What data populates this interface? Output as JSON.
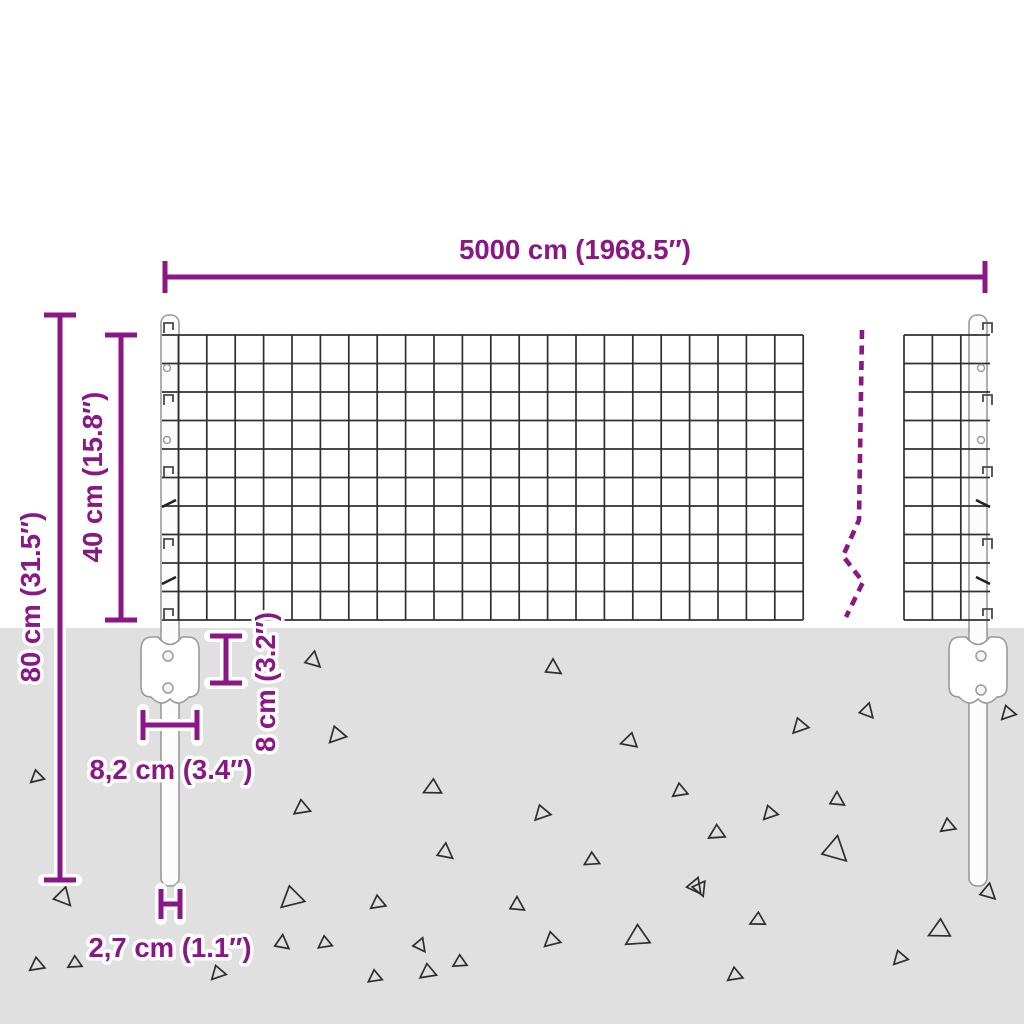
{
  "diagram": {
    "type": "product-dimension-diagram",
    "subject": "wire mesh fence panel with ground posts",
    "labels": {
      "total_width": "5000 cm (1968.5″)",
      "post_height": "80 cm (31.5″)",
      "mesh_height": "40 cm (15.8″)",
      "anchor_depth": "8 cm (3.2″)",
      "anchor_width": "8,2 cm (3.4″)",
      "post_diameter": "2,7 cm (1.1″)"
    },
    "colors": {
      "dimension": "#8B1786",
      "ground": "#E0E0E0",
      "mesh_line": "#303030",
      "post_outline": "#9A9A9A",
      "triangle_outline": "#2E2E2E",
      "background": "#FFFFFF"
    },
    "ground": {
      "triangles": [
        [
          313,
          660,
          13,
          10
        ],
        [
          553,
          668,
          13,
          0
        ],
        [
          337,
          735,
          14,
          100
        ],
        [
          630,
          741,
          13,
          130
        ],
        [
          433,
          788,
          14,
          120
        ],
        [
          302,
          808,
          13,
          110
        ],
        [
          542,
          813,
          13,
          100
        ],
        [
          800,
          726,
          13,
          100
        ],
        [
          867,
          711,
          12,
          15
        ],
        [
          680,
          791,
          12,
          110
        ],
        [
          770,
          813,
          12,
          100
        ],
        [
          837,
          800,
          12,
          0
        ],
        [
          717,
          833,
          13,
          115
        ],
        [
          948,
          826,
          12,
          110
        ],
        [
          835,
          850,
          21,
          10
        ],
        [
          695,
          886,
          13,
          20
        ],
        [
          445,
          852,
          13,
          5
        ],
        [
          292,
          898,
          19,
          105
        ],
        [
          378,
          903,
          12,
          110
        ],
        [
          517,
          905,
          12,
          0
        ],
        [
          592,
          860,
          12,
          115
        ],
        [
          552,
          940,
          13,
          105
        ],
        [
          638,
          937,
          19,
          115
        ],
        [
          428,
          972,
          13,
          110
        ],
        [
          700,
          888,
          12,
          35
        ],
        [
          758,
          920,
          12,
          120
        ],
        [
          735,
          975,
          12,
          110
        ],
        [
          37,
          777,
          11,
          105
        ],
        [
          63,
          897,
          15,
          15
        ],
        [
          37,
          965,
          12,
          110
        ],
        [
          75,
          963,
          11,
          115
        ],
        [
          218,
          973,
          12,
          100
        ],
        [
          282,
          943,
          12,
          5
        ],
        [
          325,
          943,
          11,
          110
        ],
        [
          375,
          977,
          11,
          110
        ],
        [
          420,
          945,
          11,
          20
        ],
        [
          460,
          962,
          11,
          115
        ],
        [
          940,
          930,
          17,
          120
        ],
        [
          988,
          892,
          13,
          10
        ],
        [
          900,
          958,
          12,
          100
        ],
        [
          1008,
          713,
          12,
          100
        ]
      ]
    }
  }
}
